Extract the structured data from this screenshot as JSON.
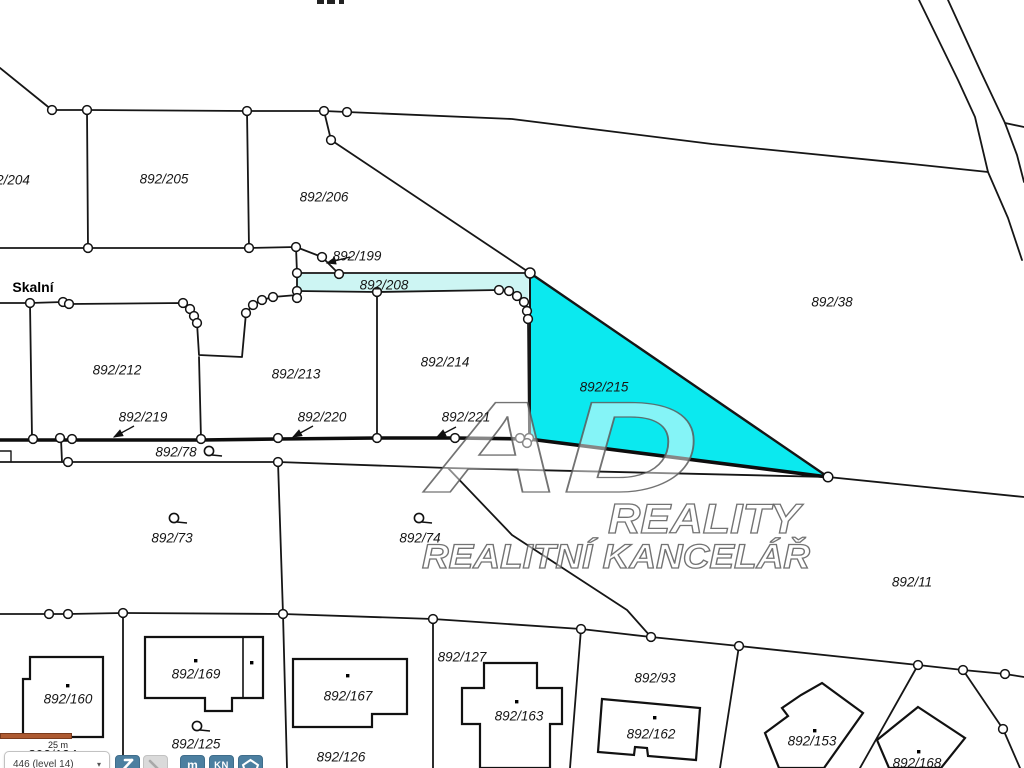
{
  "map": {
    "street_label": "Skalní",
    "highlight": {
      "parcels": [
        "892/208",
        "892/215"
      ],
      "strip_color": "#cdf5f3",
      "triangle_color": "#0be9ef"
    },
    "watermark": {
      "line1": "AD",
      "line2": "REALITY",
      "line3": "REALITNÍ KANCELÁŘ"
    },
    "labels": [
      {
        "text": "2/204",
        "x": 13,
        "y": 180,
        "kind": "parcel"
      },
      {
        "text": "892/205",
        "x": 164,
        "y": 179,
        "kind": "parcel"
      },
      {
        "text": "892/206",
        "x": 324,
        "y": 197,
        "kind": "parcel"
      },
      {
        "text": "892/199",
        "x": 357,
        "y": 256,
        "kind": "parcel"
      },
      {
        "text": "892/208",
        "x": 384,
        "y": 285,
        "kind": "parcel"
      },
      {
        "text": "Skalní",
        "x": 33,
        "y": 287,
        "kind": "street"
      },
      {
        "text": "892/212",
        "x": 117,
        "y": 370,
        "kind": "parcel"
      },
      {
        "text": "892/213",
        "x": 296,
        "y": 374,
        "kind": "parcel"
      },
      {
        "text": "892/214",
        "x": 445,
        "y": 362,
        "kind": "parcel"
      },
      {
        "text": "892/215",
        "x": 604,
        "y": 387,
        "kind": "parcel"
      },
      {
        "text": "892/38",
        "x": 832,
        "y": 302,
        "kind": "parcel"
      },
      {
        "text": "892/219",
        "x": 143,
        "y": 417,
        "kind": "parcel"
      },
      {
        "text": "892/220",
        "x": 322,
        "y": 417,
        "kind": "parcel"
      },
      {
        "text": "892/221",
        "x": 466,
        "y": 417,
        "kind": "parcel"
      },
      {
        "text": "892/78",
        "x": 176,
        "y": 452,
        "kind": "parcel"
      },
      {
        "text": "892/73",
        "x": 172,
        "y": 538,
        "kind": "parcel"
      },
      {
        "text": "892/74",
        "x": 420,
        "y": 538,
        "kind": "parcel"
      },
      {
        "text": "892/11",
        "x": 912,
        "y": 582,
        "kind": "parcel"
      },
      {
        "text": "892/160",
        "x": 68,
        "y": 699,
        "kind": "parcel"
      },
      {
        "text": "892/169",
        "x": 196,
        "y": 674,
        "kind": "parcel"
      },
      {
        "text": "892/167",
        "x": 348,
        "y": 696,
        "kind": "parcel"
      },
      {
        "text": "892/127",
        "x": 462,
        "y": 657,
        "kind": "parcel"
      },
      {
        "text": "892/125",
        "x": 196,
        "y": 744,
        "kind": "parcel"
      },
      {
        "text": "892/126",
        "x": 341,
        "y": 757,
        "kind": "parcel"
      },
      {
        "text": "892/124",
        "x": 52,
        "y": 755,
        "kind": "parcel"
      },
      {
        "text": "892/93",
        "x": 655,
        "y": 678,
        "kind": "parcel"
      },
      {
        "text": "892/163",
        "x": 519,
        "y": 716,
        "kind": "parcel"
      },
      {
        "text": "892/162",
        "x": 651,
        "y": 734,
        "kind": "parcel"
      },
      {
        "text": "892/153",
        "x": 812,
        "y": 741,
        "kind": "parcel"
      },
      {
        "text": "892/168",
        "x": 917,
        "y": 763,
        "kind": "parcel"
      }
    ]
  },
  "controls": {
    "scale_label": "25 m",
    "level_text": "446 (level 14)",
    "toolbar": {
      "measure_label": "m",
      "kn_label": "KN"
    },
    "button_blue": "#4c7fa0",
    "scalebar_color": "#ad5a31"
  }
}
